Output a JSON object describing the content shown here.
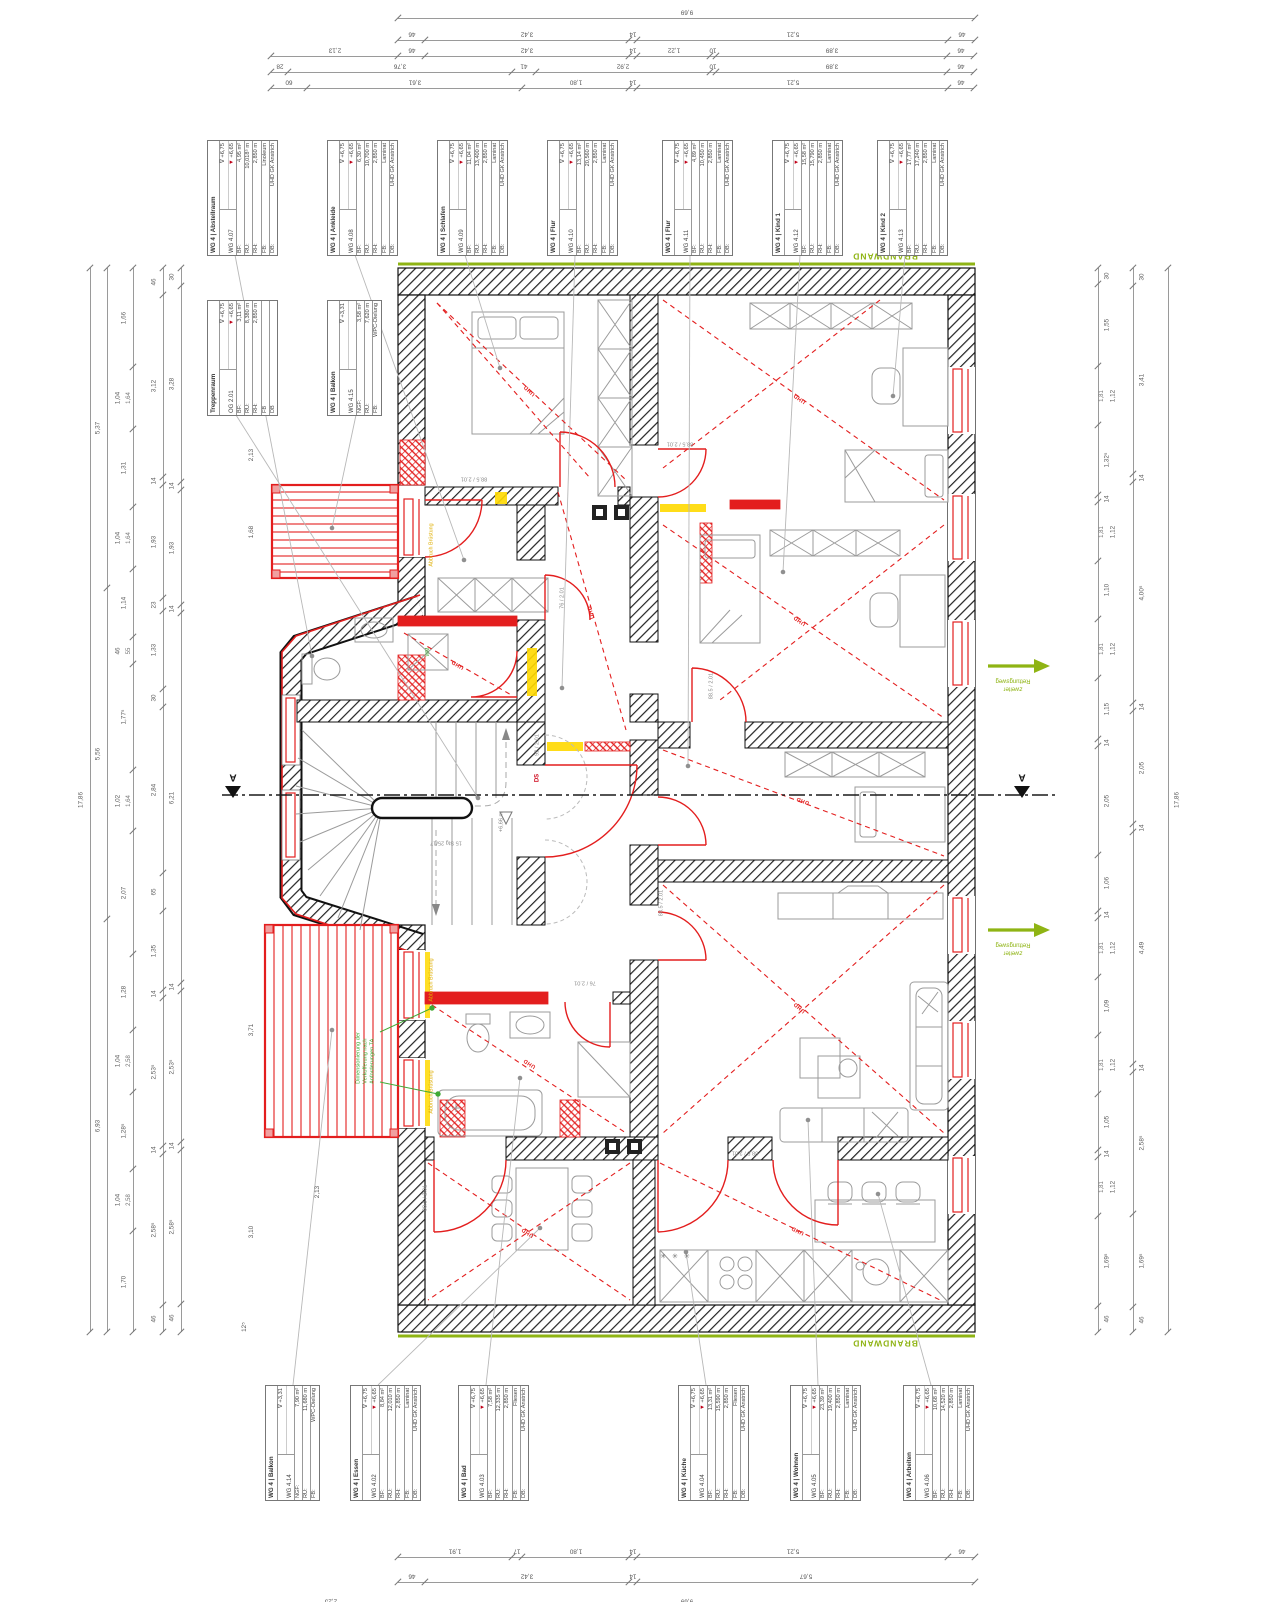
{
  "info_boxes": [
    {
      "x": 207,
      "y": 140,
      "title": "WG 4 | Abstellraum",
      "room": "WG 4.07",
      "lv1": "+6,75",
      "lv2": "+6,65",
      "rows": [
        [
          "BF:",
          "4,95 m²"
        ],
        [
          "RU:",
          "10,018⁵ m"
        ],
        [
          "RH:",
          "2,850 m"
        ],
        [
          "FB:",
          "Linoleum"
        ],
        [
          "DB:",
          "UHD GK Anstrich"
        ]
      ]
    },
    {
      "x": 327,
      "y": 140,
      "title": "WG 4 | Ankleide",
      "room": "WG 4.08",
      "lv1": "+6,75",
      "lv2": "+6,65",
      "rows": [
        [
          "BF:",
          "6,30 m²"
        ],
        [
          "RU:",
          "10,700 m"
        ],
        [
          "RH:",
          "2,850 m"
        ],
        [
          "FB:",
          "Laminat"
        ],
        [
          "DB:",
          "UHD GK Anstrich"
        ]
      ]
    },
    {
      "x": 437,
      "y": 140,
      "title": "WG 4 | Schlafen",
      "room": "WG 4.09",
      "lv1": "+6,75",
      "lv2": "+6,65",
      "rows": [
        [
          "BF:",
          "11,04 m²"
        ],
        [
          "RU:",
          "13,400 m"
        ],
        [
          "RH:",
          "2,850 m"
        ],
        [
          "FB:",
          "Laminat"
        ],
        [
          "DB:",
          "UHD GK Anstrich"
        ]
      ]
    },
    {
      "x": 547,
      "y": 140,
      "title": "WG 4 | Flur",
      "room": "WG 4.10",
      "lv1": "+6,75",
      "lv2": "+6,65",
      "rows": [
        [
          "BF:",
          "13,14 m²"
        ],
        [
          "RU:",
          "20,560 m"
        ],
        [
          "RH:",
          "2,850 m"
        ],
        [
          "FB:",
          "Laminat"
        ],
        [
          "DB:",
          "UHD GK Anstrich"
        ]
      ]
    },
    {
      "x": 662,
      "y": 140,
      "title": "WG 4 | Flur",
      "room": "WG 4.11",
      "lv1": "+6,75",
      "lv2": "+6,65",
      "rows": [
        [
          "BF:",
          "4,89 m²"
        ],
        [
          "RU:",
          "10,450 m"
        ],
        [
          "RH:",
          "2,850 m"
        ],
        [
          "FB:",
          "Laminat"
        ],
        [
          "DB:",
          "UHD GK Anstrich"
        ]
      ]
    },
    {
      "x": 772,
      "y": 140,
      "title": "WG 4 | Kind 1",
      "room": "WG 4.12",
      "lv1": "+6,75",
      "lv2": "+6,65",
      "rows": [
        [
          "BF:",
          "15,58 m²"
        ],
        [
          "RU:",
          "15,790 m"
        ],
        [
          "RH:",
          "2,850 m"
        ],
        [
          "FB:",
          "Laminat"
        ],
        [
          "DB:",
          "UHD GK Anstrich"
        ]
      ]
    },
    {
      "x": 877,
      "y": 140,
      "title": "WG 4 | Kind 2",
      "room": "WG 4.13",
      "lv1": "+6,75",
      "lv2": "+6,65",
      "rows": [
        [
          "BF:",
          "17,77 m²"
        ],
        [
          "RU:",
          "17,240 m"
        ],
        [
          "RH:",
          "2,850 m"
        ],
        [
          "FB:",
          "Laminat"
        ],
        [
          "DB:",
          "UHD GK Anstrich"
        ]
      ]
    },
    {
      "x": 207,
      "y": 300,
      "title": "Treppenraum",
      "room": "OG 2.01",
      "lv1": "+6,75",
      "lv2": "+6,65",
      "rows": [
        [
          "BF:",
          "3,11 m²"
        ],
        [
          "RU:",
          "8,380 m"
        ],
        [
          "RH:",
          "2,850 m"
        ],
        [
          "FB",
          ""
        ],
        [
          "DB",
          ""
        ]
      ]
    },
    {
      "x": 327,
      "y": 300,
      "title": "WG 4 | Balkon",
      "room": "WG 4.15",
      "lv1": "+3,31",
      "lv2": "",
      "rows": [
        [
          "NGF:",
          "3,58 m²"
        ],
        [
          "RU:",
          "7,620 m"
        ],
        [
          "FB:",
          "WPC-Dielung"
        ]
      ]
    },
    {
      "x": 265,
      "y": 1385,
      "title": "WG 4 | Balkon",
      "room": "WG 4.14",
      "lv1": "+3,31",
      "lv2": "",
      "rows": [
        [
          "NGF:",
          "7,90 m²"
        ],
        [
          "RU:",
          "11,680 m"
        ],
        [
          "FB:",
          "WPC-Dielung"
        ]
      ]
    },
    {
      "x": 350,
      "y": 1385,
      "title": "WG 4 | Essen",
      "room": "WG 4.02",
      "lv1": "+6,75",
      "lv2": "+6,65",
      "rows": [
        [
          "BF:",
          "8,84 m²"
        ],
        [
          "RU:",
          "12,010 m"
        ],
        [
          "RH:",
          "2,850 m"
        ],
        [
          "FB:",
          "Laminat"
        ],
        [
          "DB:",
          "UHD GK Anstrich"
        ]
      ]
    },
    {
      "x": 458,
      "y": 1385,
      "title": "WG 4 | Bad",
      "room": "WG 4.03",
      "lv1": "+6,75",
      "lv2": "+6,65",
      "rows": [
        [
          "BF:",
          "7,58 m²"
        ],
        [
          "RU:",
          "12,335 m"
        ],
        [
          "RH:",
          "2,850 m"
        ],
        [
          "FB:",
          "Fliesen"
        ],
        [
          "DB:",
          "UHD GK Anstrich"
        ]
      ]
    },
    {
      "x": 678,
      "y": 1385,
      "title": "WG 4 | Küche",
      "room": "WG 4.04",
      "lv1": "+6,75",
      "lv2": "+6,65",
      "rows": [
        [
          "BF:",
          "13,31 m²"
        ],
        [
          "RU:",
          "15,590 m"
        ],
        [
          "RH:",
          "2,850 m"
        ],
        [
          "FB:",
          "Fliesen"
        ],
        [
          "DB:",
          "UHD GK Anstrich"
        ]
      ]
    },
    {
      "x": 790,
      "y": 1385,
      "title": "WG 4 | Wohnen",
      "room": "WG 4.05",
      "lv1": "+6,75",
      "lv2": "+6,65",
      "rows": [
        [
          "BF:",
          "23,39 m²"
        ],
        [
          "RU:",
          "19,400 m"
        ],
        [
          "RH:",
          "2,850 m"
        ],
        [
          "FB:",
          "Laminat"
        ],
        [
          "DB:",
          "UHD GK Anstrich"
        ]
      ]
    },
    {
      "x": 903,
      "y": 1385,
      "title": "WG 4 | Arbeiten",
      "room": "WG 4.06",
      "lv1": "+6,75",
      "lv2": "+6,65",
      "rows": [
        [
          "BF:",
          "10,68 m²"
        ],
        [
          "RU:",
          "14,520 m"
        ],
        [
          "RH:",
          "2,850 m"
        ],
        [
          "FB:",
          "Laminat"
        ],
        [
          "DB:",
          "UHD GK Anstrich"
        ]
      ]
    }
  ],
  "dim_chains": [
    {
      "o": "h",
      "x": 398,
      "y": 8,
      "flip": true,
      "segs": [
        [
          "9,69",
          577
        ]
      ]
    },
    {
      "o": "h",
      "x": 398,
      "y": 30,
      "flip": true,
      "segs": [
        [
          "46",
          27
        ],
        [
          "3,42",
          204
        ],
        [
          "14",
          8
        ],
        [
          "5,21",
          311
        ],
        [
          "46",
          27
        ]
      ]
    },
    {
      "o": "h",
      "x": 271,
      "y": 46,
      "flip": true,
      "segs": [
        [
          "2,13",
          127
        ],
        [
          "46",
          27
        ],
        [
          "3,42",
          204
        ],
        [
          "14",
          8
        ],
        [
          "1,22",
          73
        ],
        [
          "10",
          6
        ],
        [
          "3,89",
          231
        ],
        [
          "46",
          27
        ]
      ]
    },
    {
      "o": "h",
      "x": 271,
      "y": 62,
      "flip": true,
      "segs": [
        [
          "28",
          17
        ],
        [
          "3,76",
          224
        ],
        [
          "41",
          24
        ],
        [
          "2,92",
          174
        ],
        [
          "10",
          6
        ],
        [
          "3,89",
          231
        ],
        [
          "46",
          27
        ]
      ]
    },
    {
      "o": "h",
      "x": 271,
      "y": 78,
      "flip": true,
      "segs": [
        [
          "60",
          36
        ],
        [
          "3,61",
          215
        ],
        [
          "1,80",
          107
        ],
        [
          "14",
          8
        ],
        [
          "5,21",
          311
        ],
        [
          "46",
          26
        ]
      ]
    },
    {
      "o": "h",
      "x": 398,
      "y": 1547,
      "flip": true,
      "segs": [
        [
          "1,91",
          114
        ],
        [
          "17",
          10
        ],
        [
          "1,80",
          107
        ],
        [
          "14",
          8
        ],
        [
          "5,21",
          311
        ],
        [
          "46",
          27
        ]
      ]
    },
    {
      "o": "h",
      "x": 398,
      "y": 1572,
      "flip": true,
      "segs": [
        [
          "46",
          27
        ],
        [
          "3,42",
          204
        ],
        [
          "14",
          8
        ],
        [
          "5,67",
          338
        ]
      ]
    },
    {
      "o": "h",
      "x": 264,
      "y": 1597,
      "flip": true,
      "segs": [
        [
          "2,25",
          134
        ],
        [
          "9,69",
          577
        ]
      ]
    },
    {
      "o": "v",
      "x": 90,
      "y": 268,
      "ls": -1,
      "segs": [
        [
          "17,86",
          1064
        ]
      ]
    },
    {
      "o": "v",
      "x": 107,
      "y": 268,
      "ls": -1,
      "segs": [
        [
          "5,37",
          320
        ],
        [
          "5,56",
          331
        ],
        [
          "6,93",
          413
        ]
      ]
    },
    {
      "o": "v",
      "x": 133,
      "y": 268,
      "ls": -1,
      "segs": [
        [
          "1,66",
          99
        ],
        [
          "1,04",
          62,
          "1,64"
        ],
        [
          "1,31",
          78
        ],
        [
          "1,04",
          62,
          "1,64"
        ],
        [
          "1,14",
          68
        ],
        [
          "46",
          27,
          "55"
        ],
        [
          "1,77⁵",
          106
        ],
        [
          "1,02",
          61,
          "1,64"
        ],
        [
          "2,07",
          123
        ],
        [
          "1,28",
          76
        ],
        [
          "1,04",
          62,
          "2,58"
        ],
        [
          "1,28⁵",
          77
        ],
        [
          "1,04",
          62,
          "2,58"
        ],
        [
          "1,70",
          101
        ]
      ]
    },
    {
      "o": "v",
      "x": 163,
      "y": 268,
      "ls": -1,
      "segs": [
        [
          "46",
          27
        ],
        [
          "3,12",
          182
        ],
        [
          "14",
          8
        ],
        [
          "1,93",
          113
        ],
        [
          "23",
          13
        ],
        [
          "1,33",
          78
        ],
        [
          "30",
          18
        ],
        [
          "2,84",
          166
        ],
        [
          "65",
          38
        ],
        [
          "1,35",
          79
        ],
        [
          "14",
          8
        ],
        [
          "2,53⁵",
          148
        ],
        [
          "14",
          8
        ],
        [
          "2,58⁵",
          151
        ],
        [
          "46",
          27
        ]
      ]
    },
    {
      "o": "v",
      "x": 181,
      "y": 268,
      "ls": -1,
      "segs": [
        [
          "30",
          18
        ],
        [
          "3,28",
          196
        ],
        [
          "14",
          8
        ],
        [
          "1,93",
          115
        ],
        [
          "14",
          8
        ],
        [
          "6,21",
          370
        ],
        [
          "14",
          8
        ],
        [
          "2,53⁵",
          151
        ],
        [
          "14",
          8
        ],
        [
          "2,58⁵",
          154
        ],
        [
          "46",
          28
        ]
      ]
    },
    {
      "o": "v",
      "x": 1098,
      "y": 268,
      "ls": 1,
      "segs": [
        [
          "30",
          16
        ],
        [
          "1,55",
          82
        ],
        [
          "1,12",
          59,
          "1,81"
        ],
        [
          "1,32⁵",
          70
        ],
        [
          "14",
          7
        ],
        [
          "1,12",
          59,
          "1,81"
        ],
        [
          "1,10",
          58
        ],
        [
          "1,12",
          59,
          "1,81"
        ],
        [
          "1,15",
          61
        ],
        [
          "14",
          7
        ],
        [
          "2,05",
          109
        ],
        [
          "1,06",
          56
        ],
        [
          "14",
          7
        ],
        [
          "1,12",
          59,
          "1,81"
        ],
        [
          "1,09",
          58
        ],
        [
          "1,12",
          59,
          "1,81"
        ],
        [
          "1,05",
          56
        ],
        [
          "14",
          7
        ],
        [
          "1,12",
          59,
          "1,81"
        ],
        [
          "1,69⁵",
          90
        ],
        [
          "46",
          26
        ]
      ]
    },
    {
      "o": "v",
      "x": 1133,
      "y": 268,
      "ls": 1,
      "segs": [
        [
          "30",
          18
        ],
        [
          "3,41",
          188
        ],
        [
          "14",
          8
        ],
        [
          "4,00⁵",
          221
        ],
        [
          "14",
          8
        ],
        [
          "2,05",
          113
        ],
        [
          "14",
          8
        ],
        [
          "4,49",
          232
        ],
        [
          "14",
          8
        ],
        [
          "2,58⁵",
          142
        ],
        [
          "1,69⁵",
          93
        ],
        [
          "46",
          25
        ]
      ]
    },
    {
      "o": "v",
      "x": 1168,
      "y": 268,
      "ls": 1,
      "segs": [
        [
          "17,86",
          1064
        ]
      ]
    }
  ],
  "notes": [
    {
      "t": "BRANDWAND",
      "x": 885,
      "y": 256,
      "r": 180,
      "c": "brand"
    },
    {
      "t": "BRANDWAND",
      "x": 885,
      "y": 1343,
      "r": 180,
      "c": "brand"
    },
    {
      "t": "zweiter\nRettungsweg",
      "x": 1013,
      "y": 684,
      "r": 180,
      "c": "resc"
    },
    {
      "t": "zweiter\nRettungsweg",
      "x": 1013,
      "y": 948,
      "r": 180,
      "c": "resc"
    },
    {
      "t": "UHD",
      "x": 530,
      "y": 390,
      "r": 223,
      "c": "uhd"
    },
    {
      "t": "UHD",
      "x": 800,
      "y": 398,
      "r": 215,
      "c": "uhd"
    },
    {
      "t": "UHD",
      "x": 800,
      "y": 620,
      "r": 215,
      "c": "uhd"
    },
    {
      "t": "UHD",
      "x": 803,
      "y": 800,
      "r": 200,
      "c": "uhd"
    },
    {
      "t": "UHD",
      "x": 458,
      "y": 664,
      "r": 210,
      "c": "uhd"
    },
    {
      "t": "UHD",
      "x": 530,
      "y": 1063,
      "r": 213,
      "c": "uhd"
    },
    {
      "t": "UHD",
      "x": 800,
      "y": 1007,
      "r": 221,
      "c": "uhd"
    },
    {
      "t": "UHD",
      "x": 798,
      "y": 1230,
      "r": 206,
      "c": "uhd"
    },
    {
      "t": "UHD",
      "x": 528,
      "y": 1232,
      "r": 213,
      "c": "uhd"
    },
    {
      "t": "UHD",
      "x": 592,
      "y": 612,
      "r": 254,
      "c": "uhd"
    },
    {
      "t": "88.5 / 2.01",
      "x": 474,
      "y": 478,
      "r": 180,
      "c": "door"
    },
    {
      "t": "88.5 / 2.01",
      "x": 680,
      "y": 443,
      "r": 180,
      "c": "door"
    },
    {
      "t": "76 / 2.01",
      "x": 563,
      "y": 598,
      "r": -90,
      "c": "door"
    },
    {
      "t": "88.5 / 2.01",
      "x": 712,
      "y": 686,
      "r": -90,
      "c": "door"
    },
    {
      "t": "92 / 2.01",
      "x": 538,
      "y": 745,
      "r": -90,
      "c": "door"
    },
    {
      "t": "DS",
      "x": 538,
      "y": 778,
      "r": -90,
      "c": "ds"
    },
    {
      "t": "76 / 2.01",
      "x": 585,
      "y": 982,
      "r": 180,
      "c": "door"
    },
    {
      "t": "88.5 / 2.01",
      "x": 426,
      "y": 1198,
      "r": -90,
      "c": "door"
    },
    {
      "t": "88.5 / 2.01",
      "x": 745,
      "y": 1152,
      "r": 180,
      "c": "door"
    },
    {
      "t": "88.5 / 2.01",
      "x": 662,
      "y": 903,
      "r": -90,
      "c": "door"
    },
    {
      "t": "Abbruch Brüstung",
      "x": 432,
      "y": 545,
      "r": -90,
      "c": "yel"
    },
    {
      "t": "Abbruch Brüstung",
      "x": 432,
      "y": 980,
      "r": -90,
      "c": "yel"
    },
    {
      "t": "Abbruch Brüstung",
      "x": 432,
      "y": 1092,
      "r": -90,
      "c": "yel"
    },
    {
      "t": "Dimensionierung der\nVerkofferung nach\nAnforderungen TA",
      "x": 366,
      "y": 1058,
      "r": -90,
      "c": "grn"
    },
    {
      "t": "WM",
      "x": 428,
      "y": 652,
      "r": -90,
      "c": "wm"
    },
    {
      "t": "15 Stg 25/17",
      "x": 446,
      "y": 842,
      "r": 180,
      "c": "door"
    },
    {
      "t": "+6,66 m",
      "x": 502,
      "y": 822,
      "r": -90,
      "c": "door"
    },
    {
      "t": "A",
      "x": 233,
      "y": 776,
      "r": 180,
      "c": "secA"
    },
    {
      "t": "A",
      "x": 1022,
      "y": 776,
      "r": 180,
      "c": "secA"
    },
    {
      "t": "✳ ✳ ✳",
      "x": 676,
      "y": 1258,
      "r": 0,
      "c": "frz"
    },
    {
      "t": "2,13",
      "x": 252,
      "y": 455,
      "r": -90,
      "c": "dim"
    },
    {
      "t": "1,68",
      "x": 252,
      "y": 532,
      "r": -90,
      "c": "dim"
    },
    {
      "t": "3,71",
      "x": 252,
      "y": 1030,
      "r": -90,
      "c": "dim"
    },
    {
      "t": "3,10",
      "x": 252,
      "y": 1232,
      "r": -90,
      "c": "dim"
    },
    {
      "t": "2,13",
      "x": 318,
      "y": 1192,
      "r": -90,
      "c": "dim"
    },
    {
      "t": "12⁵",
      "x": 245,
      "y": 1327,
      "r": -90,
      "c": "dim"
    }
  ],
  "colors": {
    "red": "#e31e1e",
    "green_brand": "#8fb414",
    "green_note": "#3faa34",
    "yellow": "#ffd900",
    "wall": "#1b1b1b",
    "furniture": "#9b9b9b"
  }
}
